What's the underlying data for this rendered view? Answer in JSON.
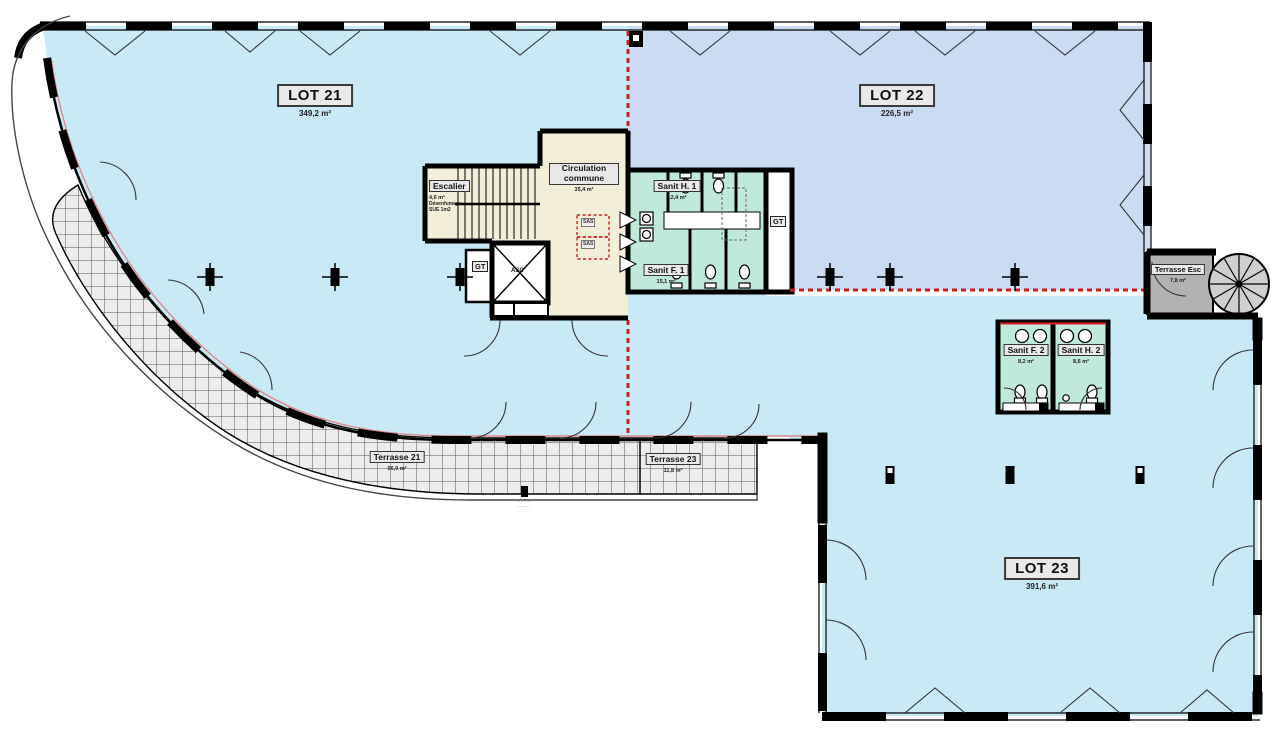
{
  "lots": [
    {
      "label": "LOT 21",
      "area": "349,2 m²"
    },
    {
      "label": "LOT 22",
      "area": "226,5 m²"
    },
    {
      "label": "LOT 23",
      "area": "391,6 m²"
    }
  ],
  "rooms": {
    "escalier": {
      "label": "Escalier",
      "area": "4,6 m²",
      "note_line1": "Désenfumage",
      "note_line2": "SUE 1m2"
    },
    "circulation": {
      "label": "Circulation commune",
      "area": "35,4 m²"
    },
    "sanit_h1": {
      "label": "Sanit H. 1",
      "area": "12,4 m²"
    },
    "sanit_f1": {
      "label": "Sanit F. 1",
      "area": "15,1 m²"
    },
    "sanit_f2": {
      "label": "Sanit F. 2",
      "area": "8,2 m²"
    },
    "sanit_h2": {
      "label": "Sanit H. 2",
      "area": "8,6 m²"
    }
  },
  "terraces": {
    "t21": {
      "label": "Terrasse 21",
      "area": "56,9 m²"
    },
    "t23": {
      "label": "Terrasse 23",
      "area": "11,8 m²"
    },
    "esc": {
      "label": "Terrasse Esc",
      "area": "7,8 m²"
    }
  },
  "annotations": {
    "gt": "GT",
    "sas": "SAS",
    "asc": "ASC",
    "tiny_note_line1": "·· ·· ····",
    "tiny_note_line2": "···· ····"
  },
  "colors": {
    "lot21_fill": "#c8eaf7",
    "lot22_fill": "#cadcf4",
    "lot23_fill": "#c8eaf7",
    "core_fill": "#f2eed8",
    "sanitary_fill": "#bfe9d9",
    "terrace_fill": "#ededed",
    "terrace_esc_fill": "#b2b2b2",
    "boundary_red": "#cc2020",
    "wall_black": "#000000"
  }
}
